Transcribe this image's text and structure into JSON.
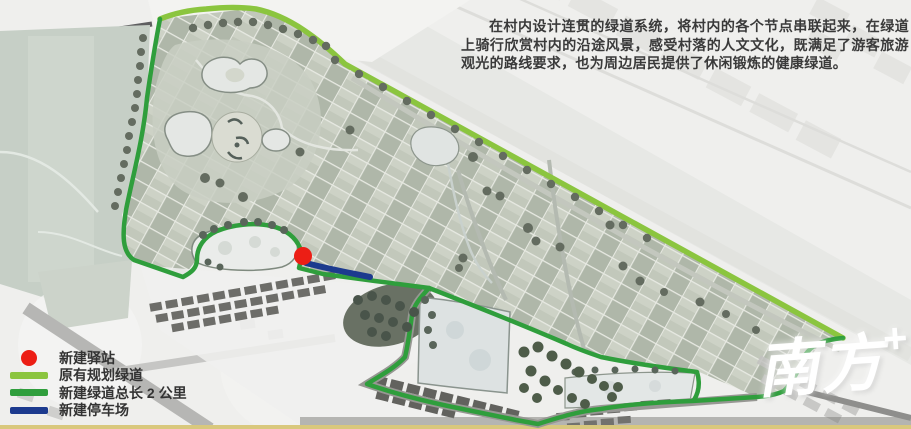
{
  "description": {
    "text": "在村内设计连贯的绿道系统，将村内的各个节点串联起来，在绿道上骑行欣赏村内的沿途风景，感受村落的人文文化，既满足了游客旅游观光的路线要求，也为周边居民提供了休闲锻炼的健康绿道。"
  },
  "legend": {
    "items": [
      {
        "symbol": "red-dot",
        "label": "新建驿站",
        "color": "#ec1e15"
      },
      {
        "symbol": "light-green-line",
        "label": "原有规划绿道",
        "color": "#8bc53f"
      },
      {
        "symbol": "green-line",
        "label": "新建绿道总长 2 公里",
        "color": "#2f9e3c"
      },
      {
        "symbol": "blue-line",
        "label": "新建停车场",
        "color": "#1c3a8e"
      }
    ]
  },
  "watermark": {
    "text": "南方",
    "plus": "+"
  },
  "map": {
    "marker": {
      "name": "new-station",
      "color": "#ec1e15"
    },
    "routes": [
      {
        "name": "existing-planned-greenway",
        "color": "#8bc53f"
      },
      {
        "name": "new-greenway",
        "color": "#2f9e3c"
      },
      {
        "name": "new-parking",
        "color": "#1c3a8e"
      }
    ]
  }
}
